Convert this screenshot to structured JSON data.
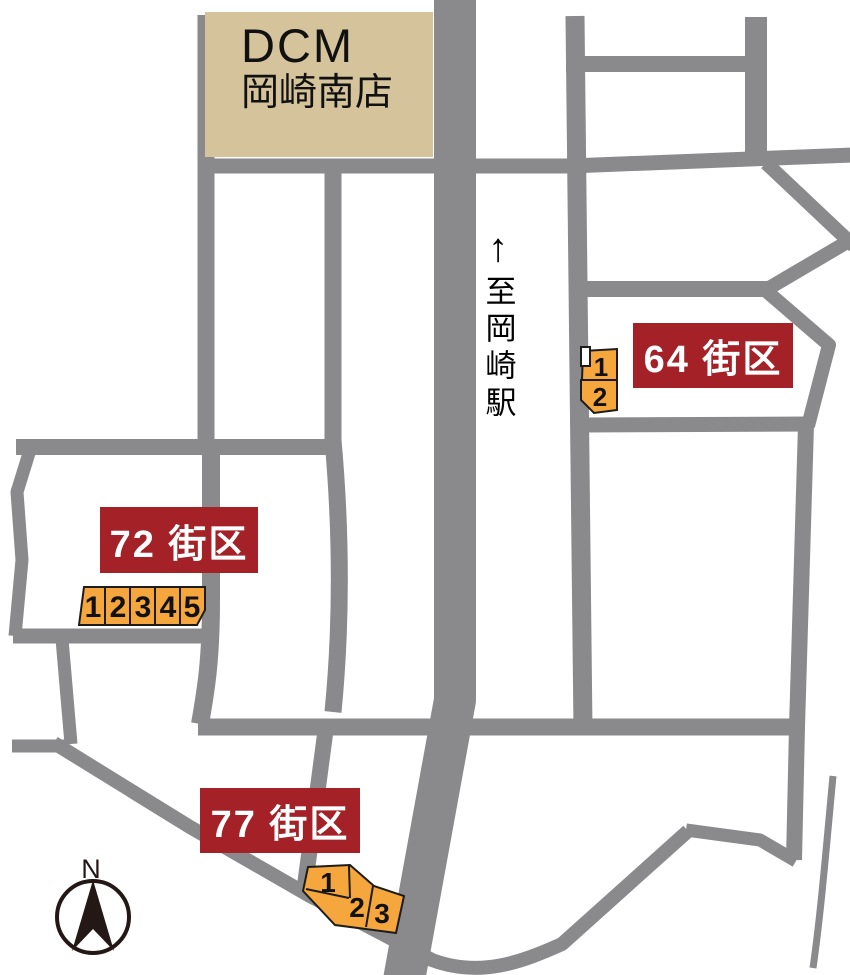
{
  "map": {
    "landmark": {
      "line1": "DCM",
      "line2": "岡崎南店"
    },
    "direction_sign": {
      "arrow": "↑",
      "destination": "至岡崎駅"
    },
    "compass": {
      "north_label": "N"
    },
    "blocks": [
      {
        "label": "64 街区",
        "lots": [
          "1",
          "2"
        ]
      },
      {
        "label": "72 街区",
        "lots": [
          "1",
          "2",
          "3",
          "4",
          "5"
        ]
      },
      {
        "label": "77 街区",
        "lots": [
          "1",
          "2",
          "3"
        ]
      }
    ],
    "colors": {
      "road": "#8A8A8C",
      "building_fill": "#D5C39B",
      "block_label_bg": "#A32127",
      "block_label_text": "#FFFFFF",
      "lot_fill": "#F5A63C",
      "lot_border": "#1C1C1C",
      "compass": "#231815"
    }
  }
}
